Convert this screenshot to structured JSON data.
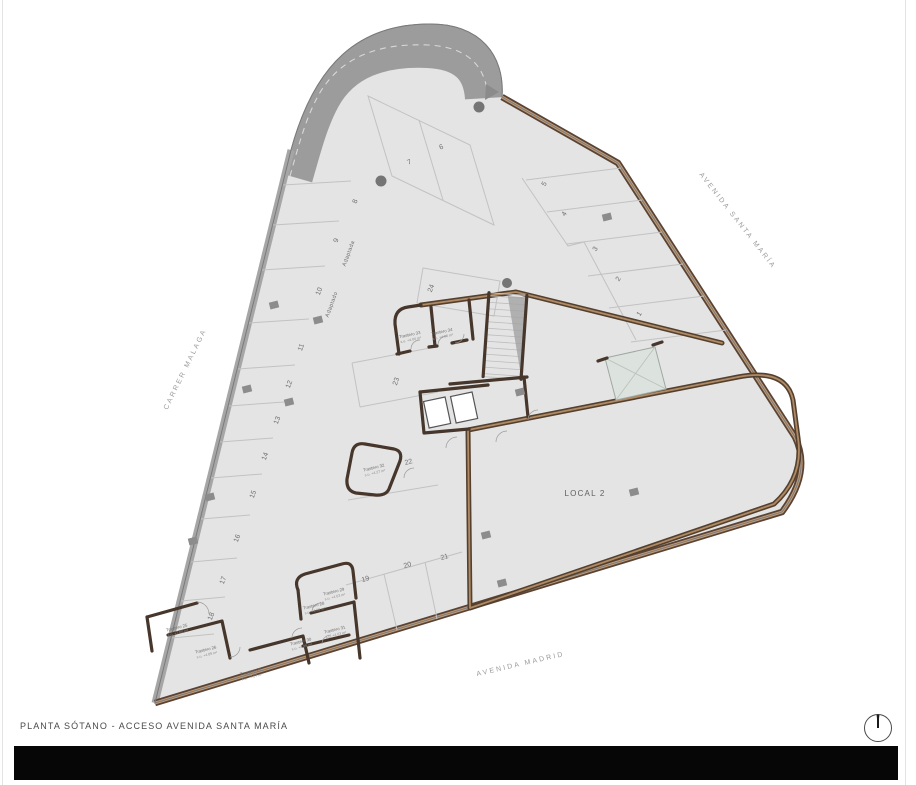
{
  "drawing": {
    "title": "PLANTA SÓTANO - ACCESO AVENIDA SANTA MARÍA"
  },
  "streets": {
    "left": "CARRER MALAGA",
    "right": "AVENIDA SANTA MARÍA",
    "bottom": "AVENIDA MADRID"
  },
  "zones": {
    "local2": "LOCAL 2"
  },
  "parking": {
    "spaces": [
      "1",
      "2",
      "3",
      "4",
      "5",
      "6",
      "7",
      "8",
      "9",
      "10",
      "11",
      "12",
      "13",
      "14",
      "15",
      "16",
      "17",
      "18",
      "19",
      "20",
      "21",
      "22",
      "23",
      "24"
    ],
    "adapted_space_9": "Adaptada",
    "adapted_space_10": "Adaptado"
  },
  "trasteros": [
    {
      "label": "Trastero 25",
      "area": "s.u. +7.00 m²"
    },
    {
      "label": "Trastero 26",
      "area": "s.u. +4.89 m²"
    },
    {
      "label": "Trastero 27",
      "area": "s.u. +7.27 m²"
    },
    {
      "label": "Trastero 28",
      "area": "s.u. +4.68 m²"
    },
    {
      "label": "Trastero 29",
      "area": "s.u. +4.03 m²"
    },
    {
      "label": "Trastero 30",
      "area": "s.u. +4.96 m²"
    },
    {
      "label": "Trastero 31",
      "area": "s.u. +4.03 m²"
    },
    {
      "label": "Trastero 32",
      "area": "s.u. +4.27 m²"
    },
    {
      "label": "Trastero 33",
      "area": "s.u. +4.00 m²"
    },
    {
      "label": "Trastero 34",
      "area": "s.u. +4.00 m²"
    }
  ],
  "colors": {
    "floor": "#e4e4e4",
    "ramp": "#9c9c9c",
    "ramp_dash": "#d8d8d8",
    "boundary_gray": "#a6a6a6",
    "wall_brown_dark": "#5a4334",
    "wall_brown_light": "#c19c77",
    "wall_interior": "#46362b",
    "patio": "#dce2de",
    "footer_bar": "#060606"
  },
  "icons": {
    "compass": "north-indicator"
  }
}
